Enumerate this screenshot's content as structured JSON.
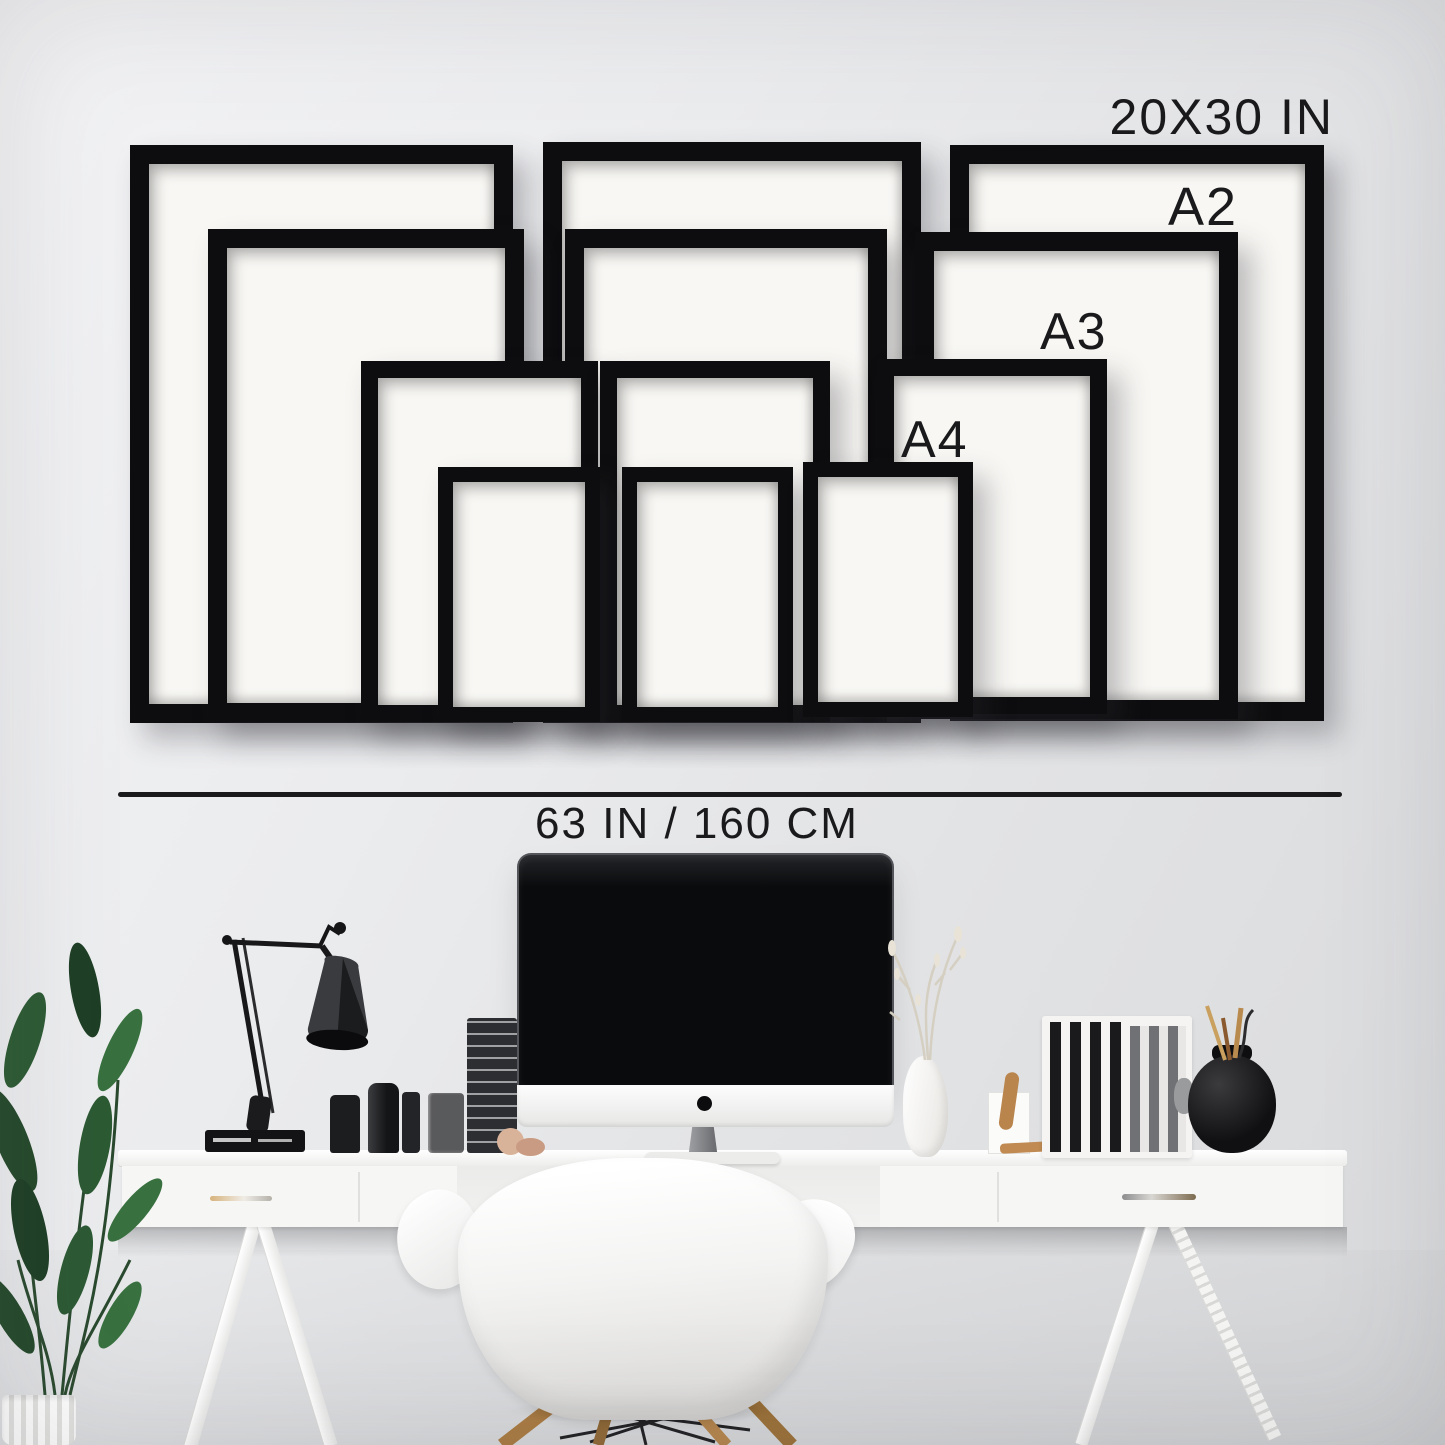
{
  "labels": {
    "frame_size_large": "20X30 IN",
    "frame_size_a2": "A2",
    "frame_size_a3": "A3",
    "frame_size_a4": "A4",
    "desk_width": "63 IN / 160 CM"
  },
  "frames": {
    "sizes": [
      "20X30 IN",
      "A2",
      "A3",
      "A4"
    ],
    "count_per_size": 3,
    "total_frames": 12,
    "frame_color": "#0d0d0f",
    "mat_color": "#f8f7f4"
  },
  "colors": {
    "wall_light": "#f3f3f5",
    "wall_dark": "#d9dadc",
    "text": "#1a1a1c",
    "divider_line": "#1a1a1c",
    "desk": "#f6f6f5",
    "chair": "#f3f3f2",
    "wood_accent": "#b5854c",
    "plant_green": "#2c5a33",
    "screen_black": "#0a0b0d"
  },
  "scene_objects": [
    "gallery-wall-frames",
    "measurement-line",
    "desk",
    "computer-monitor",
    "desk-lamp",
    "potted-plant",
    "shell-chair",
    "glass-bottles",
    "magazine-stack",
    "white-vase-with-branches",
    "book-organizer",
    "black-round-vase",
    "drawer-pulls"
  ]
}
